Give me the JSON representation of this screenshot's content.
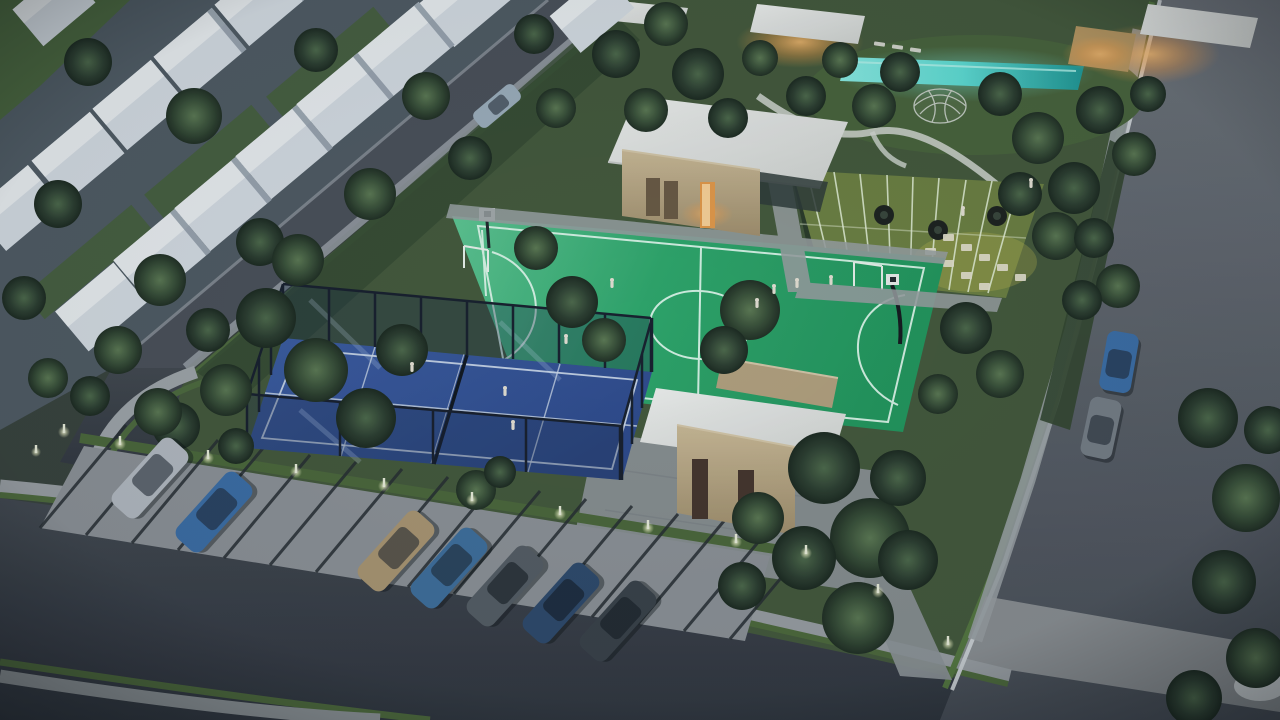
{
  "scene": {
    "type": "aerial-3d-render",
    "time_of_day": "dusk",
    "subject": "residential community amenity park with sports courts, clubhouse, pool and parking"
  },
  "amenities": [
    "multi-sport-court",
    "padel-courts",
    "swimming-pool",
    "fitness-lawn",
    "play-dome",
    "clubhouse",
    "restrooms-pavilion",
    "parking-lot"
  ],
  "vehicles": {
    "parking_lot_cars": [
      "silver",
      "blue",
      "gold",
      "teal-blue",
      "dark-grey",
      "navy",
      "charcoal"
    ],
    "street_parked_cars": [
      "blue",
      "grey"
    ],
    "street_moving_cars": [
      "silver"
    ]
  },
  "people": {
    "padel_players": 4,
    "court_players": 5,
    "fitness_lawn": 2
  },
  "palette": {
    "base": "#39423b",
    "housingGround": "#505b62",
    "gardenGreen": "#44593a",
    "lawnBright": "#4a663c",
    "courtGreenLight": "#5fc893",
    "courtGreen": "#2ea86a",
    "courtGreenDark": "#22985c",
    "courtLine": "#e2fbed",
    "padelBlue": "#3c5da2",
    "padelBlueDark": "#2e4a8c",
    "padelLine": "#d5e0ee",
    "frameDark": "#171f2c",
    "poolAqua": "#5fe0d6",
    "poolDeep": "#1f9a96",
    "roadLight": "#70757b",
    "road": "#53585f",
    "roadDark": "#3e434b",
    "sidewalk": "#a1a6a9",
    "curb": "#cdd1d3",
    "paver": "#8e9397",
    "stripe": "#262b2f",
    "grassStrip": "#4c6839",
    "roofWhite": "#ebedea",
    "wallBeige": "#c6b28c",
    "wallShadow": "#93815f",
    "doorBrown": "#45342a",
    "warm": "#ffbe72",
    "houseWhite": "#d9dfe5",
    "houseRoof": "#eef1f3",
    "houseShadow": "#86929e",
    "carSilver": "#b6bcc2",
    "carBlue": "#3c6ea6",
    "carGold": "#ad9771",
    "carTeal": "#3f6f9c",
    "carGrey": "#565d63",
    "carNavy": "#2f4a6b",
    "carCharcoal": "#3a4148",
    "bollard": "#eef2dc",
    "tire": "#1c211c"
  }
}
